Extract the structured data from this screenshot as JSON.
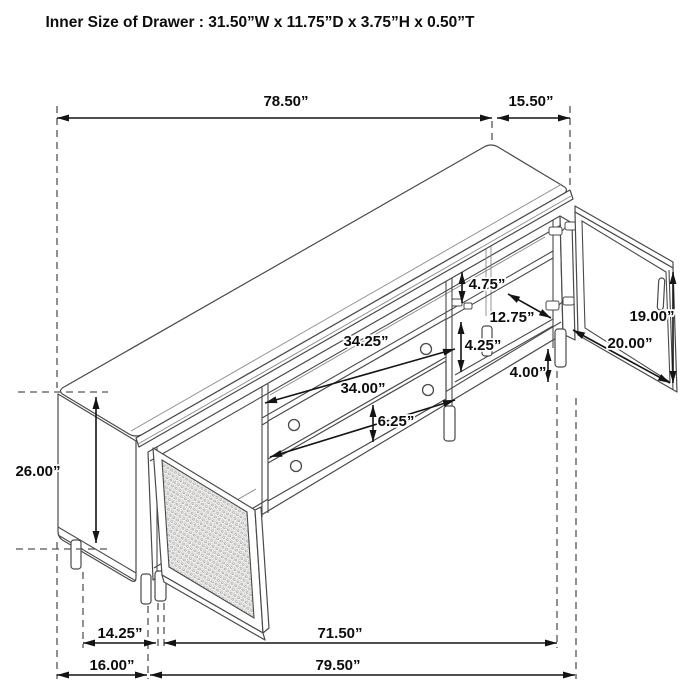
{
  "title": "Inner Size of Drawer : 31.50”W x 11.75”D x 3.75”H x 0.50”T",
  "diagram": {
    "type": "furniture-dimension-line-drawing",
    "subject": "TV console sideboard with two drawers, cane mesh left door and right glass door, isometric view"
  },
  "dims": {
    "overall_top_width": "78.50”",
    "top_depth": "15.50”",
    "overall_height": "26.00”",
    "upper_opening_height": "4.75”",
    "shelf_depth": "12.75”",
    "lower_opening_height": "4.25”",
    "leg_height": "4.00”",
    "door_opening_height": "19.00”",
    "door_opening_width": "20.00”",
    "shelf_opening_width": "34.25”",
    "drawer_face_width": "34.00”",
    "drawer_face_height": "6.25”",
    "side_leg_spacing": "14.25”",
    "side_panel_width": "16.00”",
    "inner_base_width": "71.50”",
    "overall_base_width": "79.50”"
  },
  "colors": {
    "background": "#ffffff",
    "furniture_line": "#4a4a4a",
    "dimension_line": "#141414",
    "label_text": "#0d0d0d",
    "mesh": "#999999"
  }
}
